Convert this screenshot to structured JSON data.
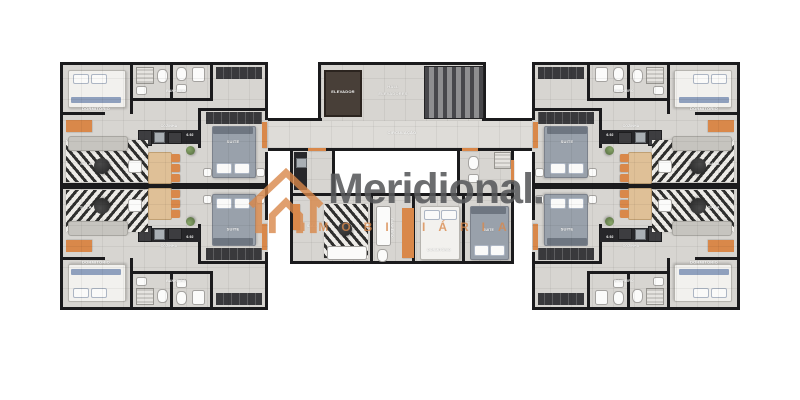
{
  "brand": {
    "name": "Meridional.",
    "tagline": "IMOBILIÁRIA",
    "accent_color": "#D9884A",
    "name_color": "#58595B"
  },
  "core": {
    "elevator": "ELEVADOR",
    "hall_line1": "HALL",
    "hall_line2": "ELEVADORES",
    "circulation": "CIRCULAÇÃO"
  },
  "rooms": {
    "bedroom": "DORMITÓRIO",
    "suite": "SUITE",
    "living": "SALA",
    "kitchen": "COZINHA",
    "bathroom": "BANHEIRO",
    "dim": "6.92"
  },
  "colors": {
    "wall": "#1B1B1D",
    "floor": "#D7D5D1",
    "door": "#D9884A",
    "counter": "#27272A"
  }
}
